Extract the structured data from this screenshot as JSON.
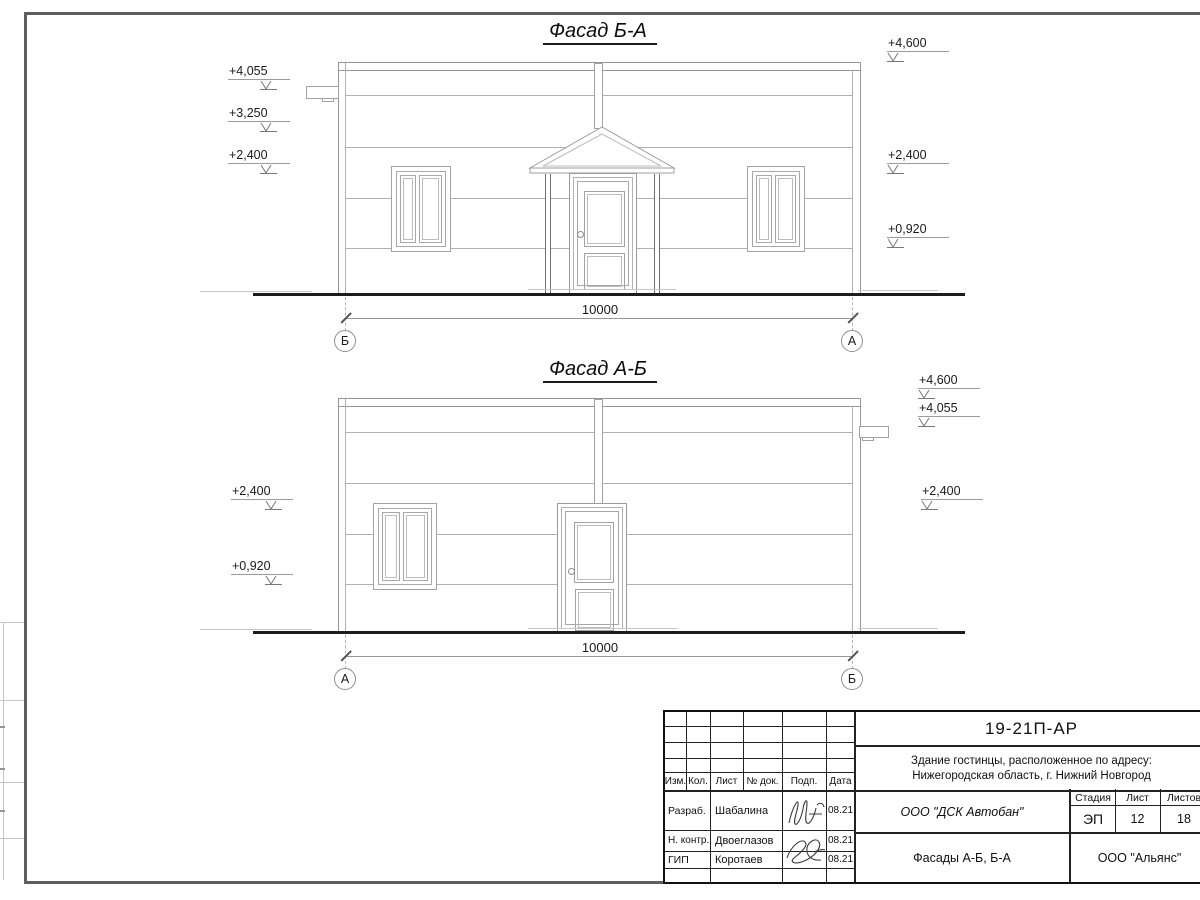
{
  "drawing": {
    "kind": "architectural-elevations",
    "colors": {
      "line_dark": "#1c1c1c",
      "line_medium": "#969696",
      "line_light": "#b0b0b0",
      "text": "#111111"
    }
  },
  "facades": [
    {
      "title": "Фасад Б-А",
      "dimension": "10000",
      "axis_left": "Б",
      "axis_right": "А",
      "marks_left": [
        "+4,055",
        "+3,250",
        "+2,400"
      ],
      "marks_right": [
        "+4,600",
        "+2,400",
        "+0,920"
      ]
    },
    {
      "title": "Фасад А-Б",
      "dimension": "10000",
      "axis_left": "А",
      "axis_right": "Б",
      "marks_left": [
        "+2,400",
        "+0,920"
      ],
      "marks_right": [
        "+4,600",
        "+4,055",
        "+2,400"
      ]
    }
  ],
  "title_block": {
    "doc_number": "19-21П-АР",
    "address_line1": "Здание гостинцы, расположенное по адресу:",
    "address_line2": "Нижегородская область, г. Нижний Новгород",
    "columns": {
      "izm": "Изм.",
      "kol": "Кол.",
      "list": "Лист",
      "doc": "№ док.",
      "podp": "Подп.",
      "data": "Дата"
    },
    "rows": [
      {
        "role": "Разраб.",
        "name": "Шабалина",
        "date": "08.21"
      },
      {
        "role": "Н. контр.",
        "name": "Двоеглазов",
        "date": "08.21"
      },
      {
        "role": "ГИП",
        "name": "Коротаев",
        "date": "08.21"
      }
    ],
    "contractor": "ООО \"ДСК Автобан\"",
    "sheet_title": "Фасады А-Б, Б-А",
    "client": "ООО \"Альянс\"",
    "stage_label": "Стадия",
    "stage": "ЭП",
    "sheet_label": "Лист",
    "sheet": "12",
    "sheets_label": "Листов",
    "sheets": "18"
  }
}
